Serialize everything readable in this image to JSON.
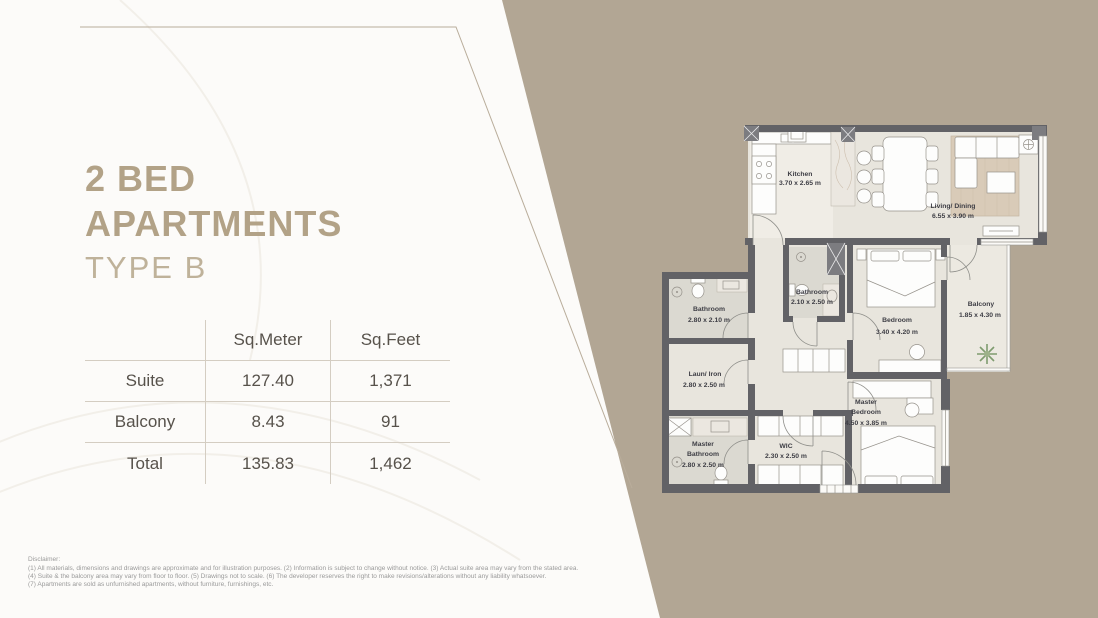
{
  "page": {
    "title_line1": "2 BED",
    "title_line2": "APARTMENTS",
    "title_line3": "TYPE B"
  },
  "colors": {
    "background_taupe": "#b2a694",
    "panel_white": "#fcfbf9",
    "title_accent": "#b2a287",
    "table_text": "#57524b",
    "plan_wall": "#626266",
    "plan_floor": "#e8e5dd",
    "plan_label_text": "#3e3e45"
  },
  "table": {
    "col_headers": [
      "Sq.Meter",
      "Sq.Feet"
    ],
    "rows": [
      {
        "label": "Suite",
        "sqm": "127.40",
        "sqft": "1,371"
      },
      {
        "label": "Balcony",
        "sqm": "8.43",
        "sqft": "91"
      },
      {
        "label": "Total",
        "sqm": "135.83",
        "sqft": "1,462"
      }
    ]
  },
  "disclaimer": {
    "heading": "Disclaimer:",
    "lines": [
      "(1) All materials, dimensions and drawings are approximate and for illustration purposes. (2) Information is subject to change without notice. (3) Actual suite area may vary from the stated area.",
      "(4) Suite & the balcony area may vary from floor to floor. (5) Drawings not to scale. (6) The developer reserves the right to make revisions/alterations without any liability whatsoever.",
      "(7) Apartments are sold as unfurnished apartments, without furniture, furnishings, etc."
    ]
  },
  "floorplan": {
    "rooms": [
      {
        "name": "Kitchen",
        "dims": "3.70 x 2.65 m"
      },
      {
        "name": "Living/ Dining",
        "dims": "6.55 x 3.90 m"
      },
      {
        "name": "Bathroom",
        "dims": "2.10 x 2.50 m"
      },
      {
        "name": "Bedroom",
        "dims": "3.40 x 4.20 m"
      },
      {
        "name": "Balcony",
        "dims": "1.85 x 4.30 m"
      },
      {
        "name": "Bathroom",
        "dims": "2.80 x 2.10 m"
      },
      {
        "name": "Laun/ Iron",
        "dims": "2.80 x 2.50 m"
      },
      {
        "name": "Master",
        "name2": "Bathroom",
        "dims": "2.80 x 2.50 m"
      },
      {
        "name": "WIC",
        "dims": "2.30 x 2.50 m"
      },
      {
        "name": "Master",
        "name2": "Bedroom",
        "dims": "4.50 x 3.85 m"
      }
    ]
  }
}
